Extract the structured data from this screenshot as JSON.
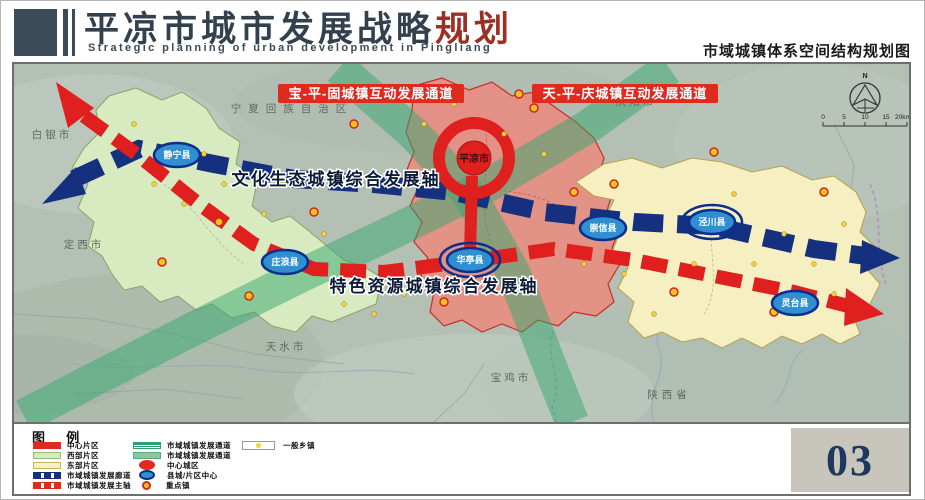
{
  "header": {
    "title_main": "平凉市城市发展战略",
    "title_accent": "规划",
    "subtitle": "Strategic planning of urban development in Pingliang",
    "map_subtitle": "市域城镇体系空间结构规划图"
  },
  "map": {
    "banners": {
      "left": "宝-平-固城镇互动发展通道",
      "right": "天-平-庆城镇互动发展通道"
    },
    "axes": {
      "north": "文化生态城镇综合发展轴",
      "south": "特色资源城镇综合发展轴"
    },
    "center_city": {
      "name": "平凉市",
      "x": 460,
      "y": 94
    },
    "cities": [
      {
        "name": "静宁县",
        "x": 163,
        "y": 91,
        "double_ring": false
      },
      {
        "name": "庄浪县",
        "x": 271,
        "y": 198,
        "double_ring": false
      },
      {
        "name": "华亭县",
        "x": 456,
        "y": 196,
        "double_ring": true
      },
      {
        "name": "崇信县",
        "x": 589,
        "y": 164,
        "double_ring": false
      },
      {
        "name": "泾川县",
        "x": 698,
        "y": 158,
        "double_ring": true
      },
      {
        "name": "灵台县",
        "x": 781,
        "y": 239,
        "double_ring": false
      }
    ],
    "region_labels": [
      {
        "text": "白银市",
        "x": 38,
        "y": 74,
        "spacing": 3
      },
      {
        "text": "定西市",
        "x": 70,
        "y": 184,
        "spacing": 3
      },
      {
        "text": "宁夏回族自治区",
        "x": 278,
        "y": 48,
        "spacing": 7
      },
      {
        "text": "庆阳市",
        "x": 622,
        "y": 41,
        "spacing": 3
      },
      {
        "text": "天水市",
        "x": 272,
        "y": 286,
        "spacing": 3
      },
      {
        "text": "宝鸡市",
        "x": 497,
        "y": 317,
        "spacing": 3
      },
      {
        "text": "陕西省",
        "x": 655,
        "y": 334,
        "spacing": 4
      }
    ],
    "key_towns": [
      {
        "x": 340,
        "y": 60
      },
      {
        "x": 520,
        "y": 44
      },
      {
        "x": 600,
        "y": 120
      },
      {
        "x": 655,
        "y": 28
      },
      {
        "x": 700,
        "y": 88
      },
      {
        "x": 810,
        "y": 128
      },
      {
        "x": 300,
        "y": 148
      },
      {
        "x": 205,
        "y": 158
      },
      {
        "x": 148,
        "y": 198
      },
      {
        "x": 235,
        "y": 232
      },
      {
        "x": 430,
        "y": 238
      },
      {
        "x": 560,
        "y": 128
      },
      {
        "x": 760,
        "y": 248
      },
      {
        "x": 660,
        "y": 228
      },
      {
        "x": 505,
        "y": 30
      }
    ],
    "towns": [
      {
        "x": 120,
        "y": 60
      },
      {
        "x": 140,
        "y": 120
      },
      {
        "x": 170,
        "y": 140
      },
      {
        "x": 190,
        "y": 90
      },
      {
        "x": 210,
        "y": 120
      },
      {
        "x": 250,
        "y": 150
      },
      {
        "x": 270,
        "y": 120
      },
      {
        "x": 310,
        "y": 170
      },
      {
        "x": 330,
        "y": 240
      },
      {
        "x": 360,
        "y": 250
      },
      {
        "x": 390,
        "y": 230
      },
      {
        "x": 410,
        "y": 60
      },
      {
        "x": 440,
        "y": 40
      },
      {
        "x": 490,
        "y": 70
      },
      {
        "x": 530,
        "y": 90
      },
      {
        "x": 570,
        "y": 200
      },
      {
        "x": 610,
        "y": 210
      },
      {
        "x": 640,
        "y": 250
      },
      {
        "x": 680,
        "y": 200
      },
      {
        "x": 720,
        "y": 130
      },
      {
        "x": 740,
        "y": 200
      },
      {
        "x": 770,
        "y": 170
      },
      {
        "x": 800,
        "y": 200
      },
      {
        "x": 830,
        "y": 160
      },
      {
        "x": 820,
        "y": 230
      }
    ],
    "compass": {
      "north": "N",
      "scale": [
        "0",
        "5",
        "10",
        "15",
        "20km"
      ]
    }
  },
  "legend": {
    "title": "图 例",
    "col1": [
      {
        "swatch": "solid-red",
        "label": "中心片区"
      },
      {
        "swatch": "solid-green",
        "label": "西部片区"
      },
      {
        "swatch": "solid-yellow",
        "label": "东部片区"
      },
      {
        "swatch": "dash-blue",
        "label": "市域城镇发展廊道"
      },
      {
        "swatch": "dash-red",
        "label": "市域城镇发展主轴"
      }
    ],
    "col2": [
      {
        "swatch": "channel-striped",
        "label": "市域城镇发展通道"
      },
      {
        "swatch": "channel-solid",
        "label": "市域城镇发展通道"
      },
      {
        "swatch": "ellipse-red",
        "label": "中心城区"
      },
      {
        "swatch": "ellipse-blue",
        "label": "县城/片区中心"
      },
      {
        "swatch": "circle-orange",
        "label": "重点镇"
      }
    ],
    "col3": [
      {
        "swatch": "dot-box",
        "label": "一般乡镇"
      }
    ]
  },
  "page_number": "03",
  "colors": {
    "accent_red": "#e02a1e",
    "corridor_blue": "#15307e",
    "channel_green": "#34a870",
    "header_slate": "#3b4b5a"
  }
}
